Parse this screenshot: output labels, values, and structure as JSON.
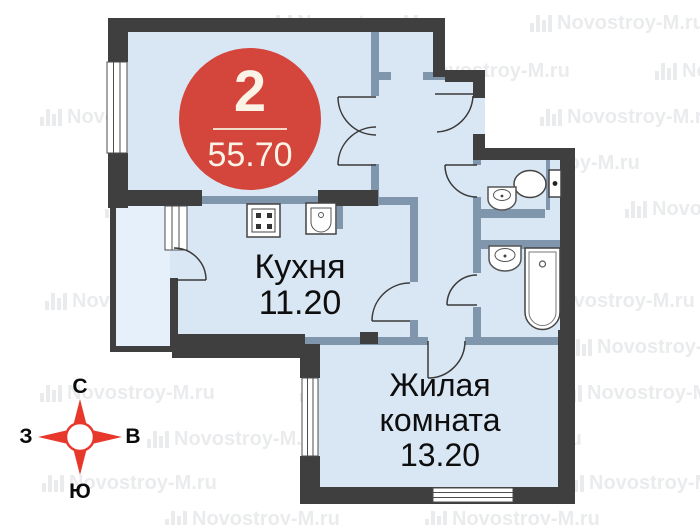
{
  "badge": {
    "rooms_count": "2",
    "area_total": "55.70"
  },
  "rooms": {
    "kitchen": {
      "name": "Кухня",
      "area": "11.20"
    },
    "living": {
      "name_line1": "Жилая",
      "name_line2": "комната",
      "area": "13.20"
    }
  },
  "compass": {
    "north": "С",
    "south": "Ю",
    "west": "З",
    "east": "В"
  },
  "watermark": {
    "text": "Novostroy-M.ru"
  },
  "icons": {
    "stove": "stove-icon",
    "kitchen_sink": "kitchen-sink-icon",
    "toilet": "toilet-icon",
    "washbasin": "washbasin-icon",
    "bathtub": "bathtub-icon",
    "compass": "compass-rose-icon",
    "watermark_logo": "building-bars-icon"
  },
  "colors": {
    "badge_red": "#d4453c",
    "compass_red": "#e8382c",
    "room_fill": "#d9e7f5",
    "balcony_fill": "#e6f0fa",
    "wall_dark": "#3f3f3f",
    "wall_light": "#7f96ad"
  }
}
